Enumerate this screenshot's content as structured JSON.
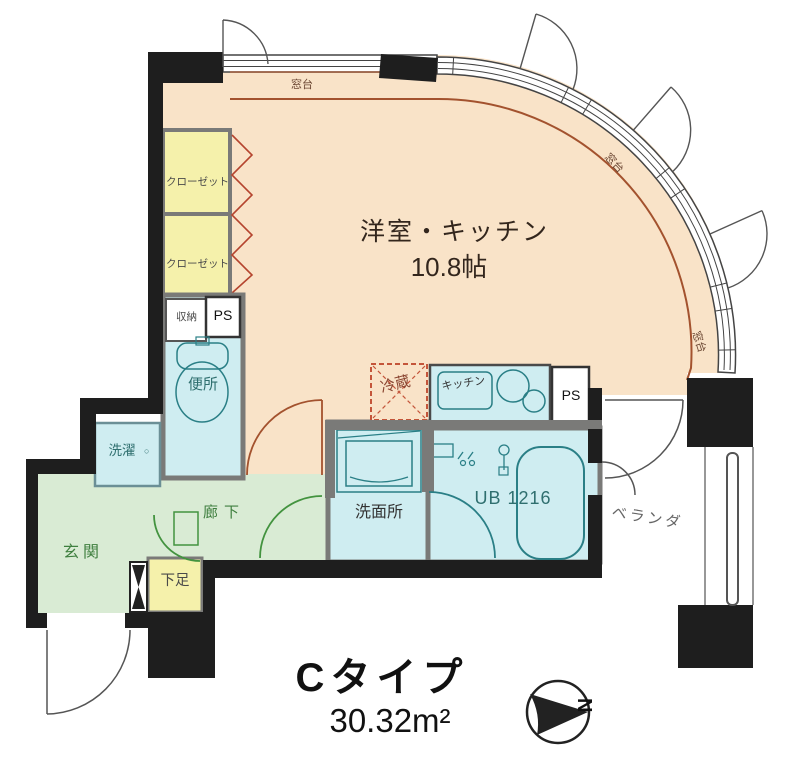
{
  "plan": {
    "type_title": "Cタイプ",
    "floor_area": "30.32m²",
    "compass_letter": "N"
  },
  "rooms": {
    "main_room_name": "洋室・キッチン",
    "main_room_size": "10.8帖",
    "closet1": "クローゼット",
    "closet2": "クローゼット",
    "storage": "収納",
    "pipe_space_upper": "PS",
    "toilet": "便所",
    "laundry": "洗濯",
    "laundry_mark": "○",
    "entrance": "玄関",
    "corridor": "廊下",
    "shoe_box": "下足",
    "washroom": "洗面所",
    "unit_bath": "UB 1216",
    "refrigerator": "冷蔵",
    "kitchen": "キッチン",
    "pipe_space_lower": "PS",
    "window_sill_top": "窓台",
    "window_sill_mid": "窓台",
    "window_sill_right": "窓台",
    "veranda": "ベランダ"
  },
  "colors": {
    "wall": "#1e1e1e",
    "partition_gray": "#7a7a78",
    "room_peach": "#f9e3c8",
    "closet_yellow": "#f5f1ab",
    "water_blue": "#cfedf1",
    "entrance_green": "#d9ebd4",
    "line_green": "#43933f",
    "line_brown": "#a3522e",
    "line_teal": "#2a7f86",
    "fixture_red": "#c4553a"
  }
}
